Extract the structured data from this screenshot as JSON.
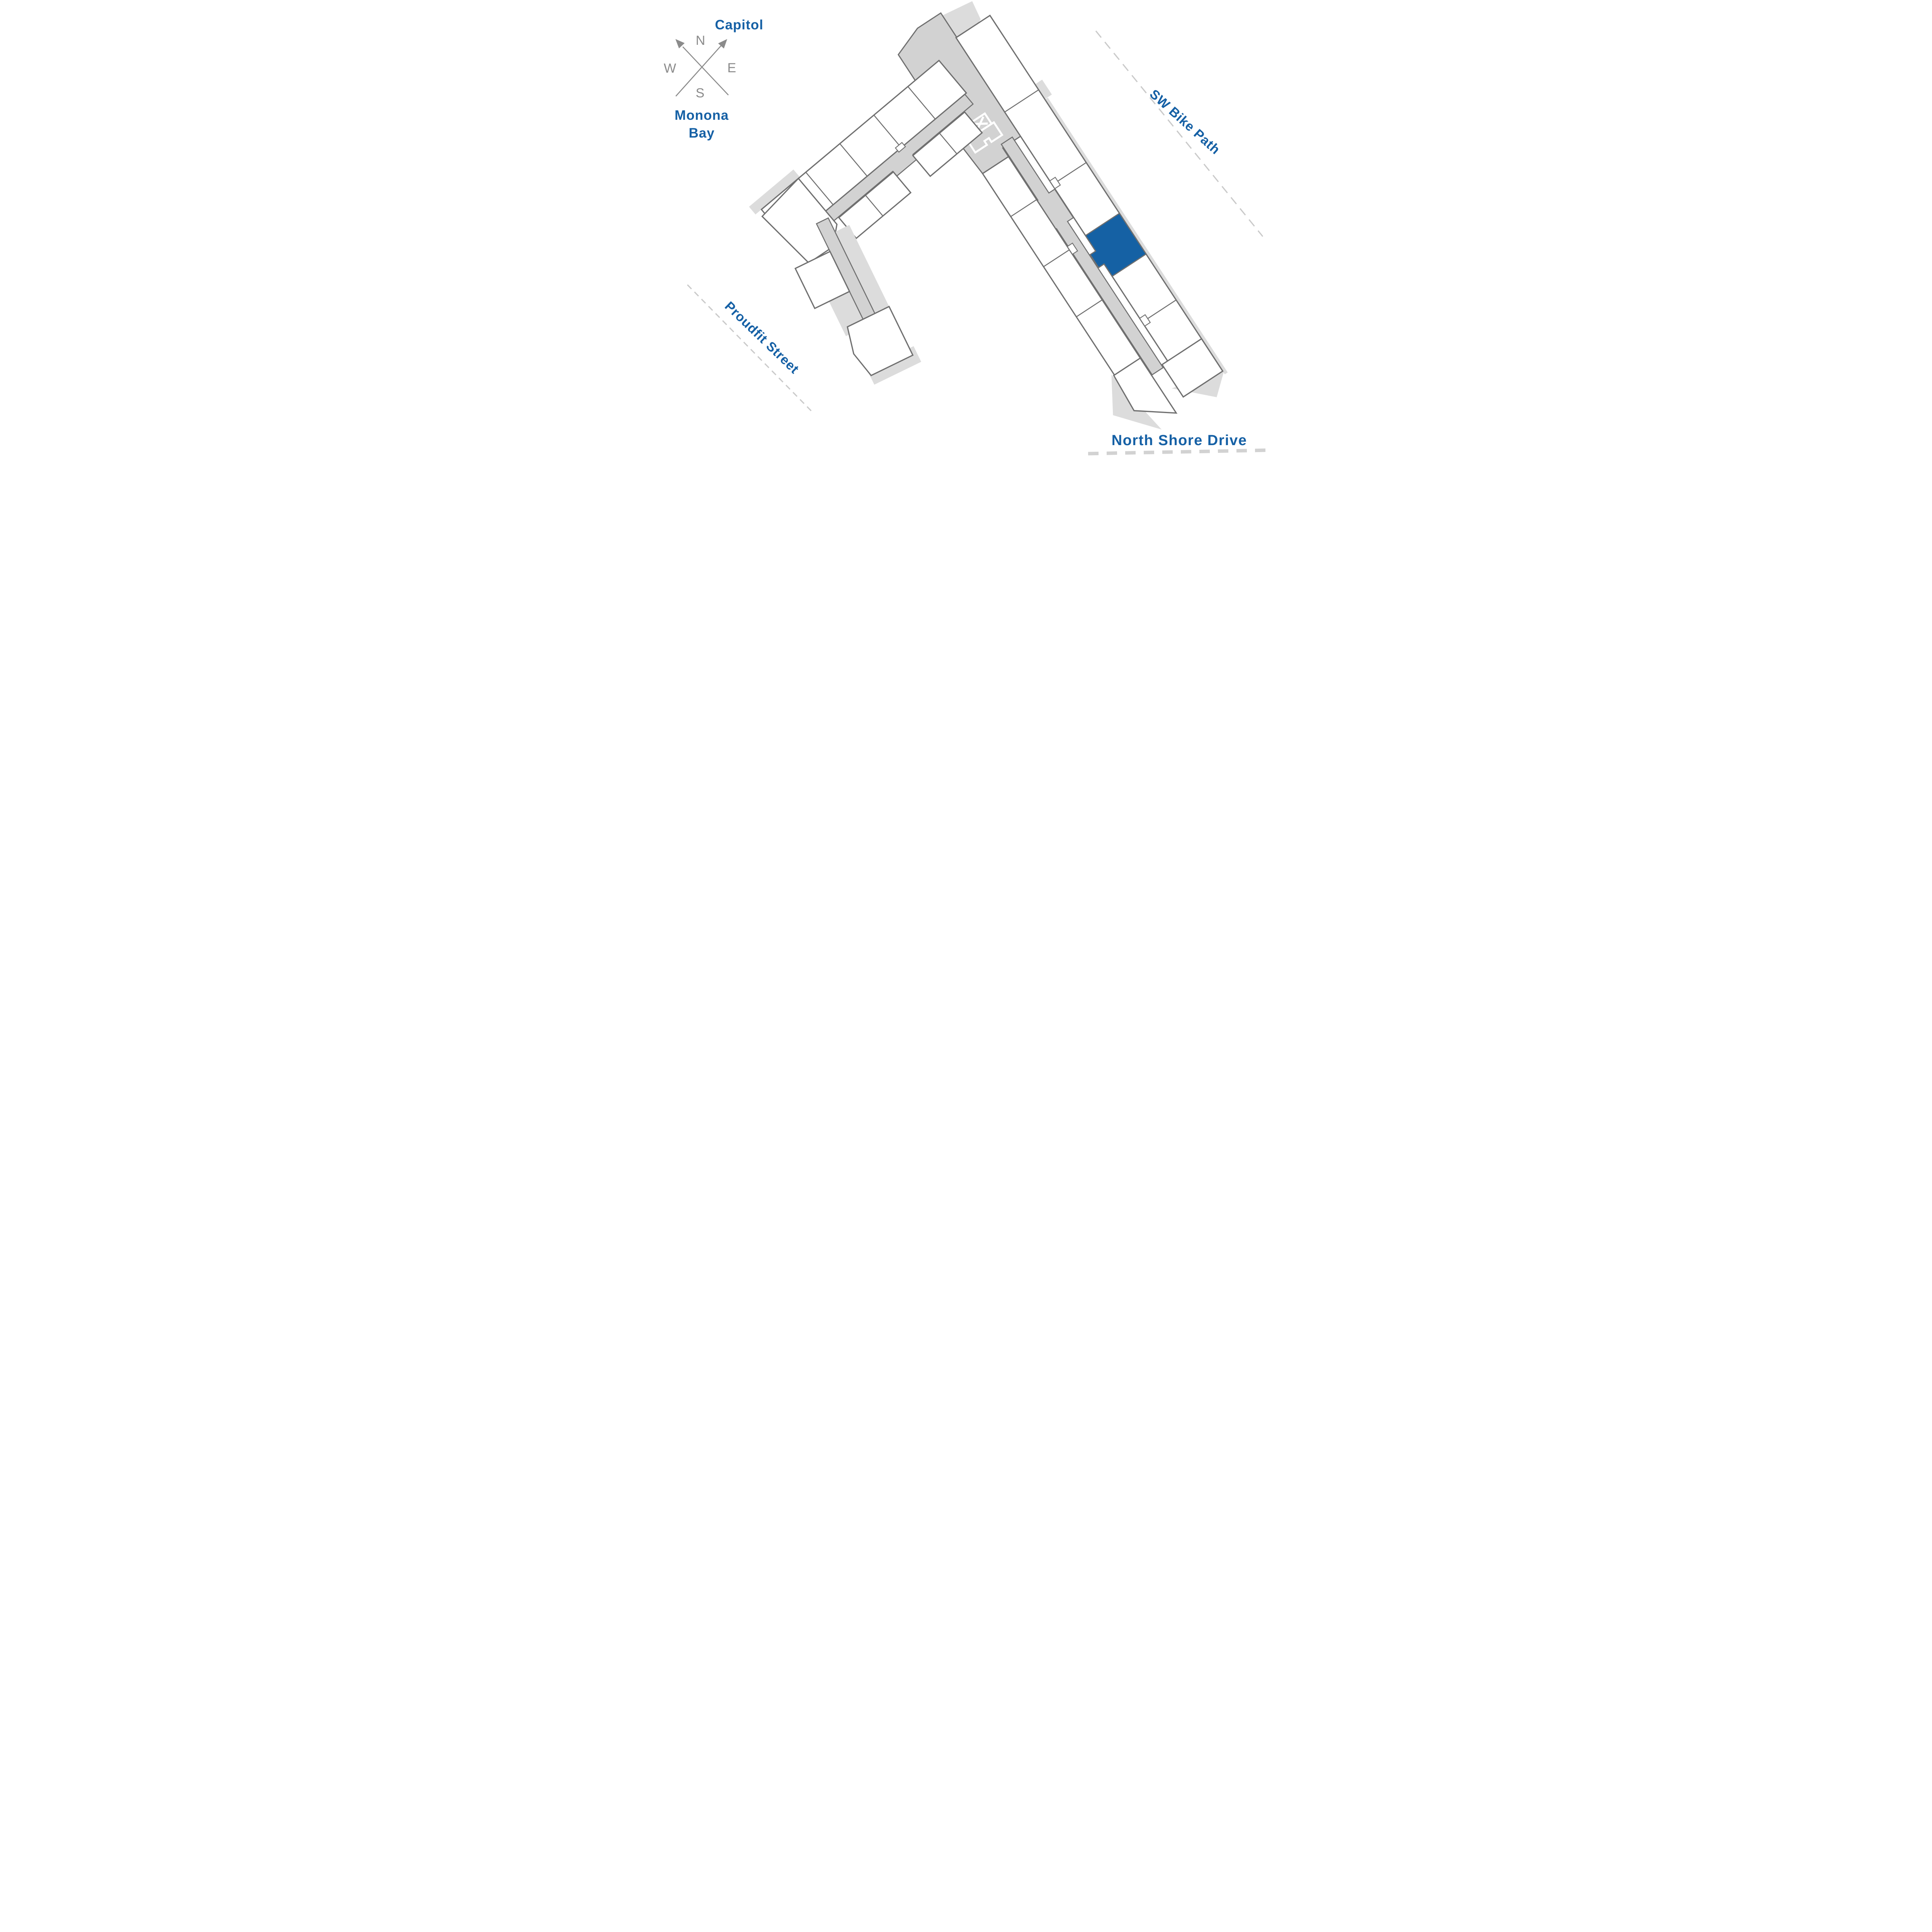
{
  "page": {
    "type": "building-site-plan",
    "background": "#FFFFFF"
  },
  "compass": {
    "north": "N",
    "east": "E",
    "south": "S",
    "west": "W",
    "arrow_northeast_points_to": "Capitol",
    "arrow_northwest_points_to": "Monona Bay"
  },
  "labels": {
    "capitol": "Capitol",
    "monona_bay_line1": "Monona",
    "monona_bay_line2": "Bay",
    "sw_bike_path": "SW Bike Path",
    "proudfit_street": "Proudfit Street",
    "north_shore_drive": "North Shore Drive"
  },
  "floor_plan": {
    "highlighted_unit": {
      "status": "selected",
      "color": "#1561A4",
      "wing": "east",
      "side": "northeast-facing"
    },
    "stair_shaft_marker": "X",
    "stair_shaft_count": 2,
    "wings": 2,
    "corridor_color": "#D2D2D2"
  },
  "colors": {
    "accent_blue": "#1561A4",
    "label_blue": "#1560A5",
    "wall_outline": "#6F6F6F",
    "corridor_fill": "#D2D2D2",
    "patio_fill": "#DCDCDC",
    "street_dash": "#CACACA",
    "compass_gray": "#8B8B8B"
  }
}
